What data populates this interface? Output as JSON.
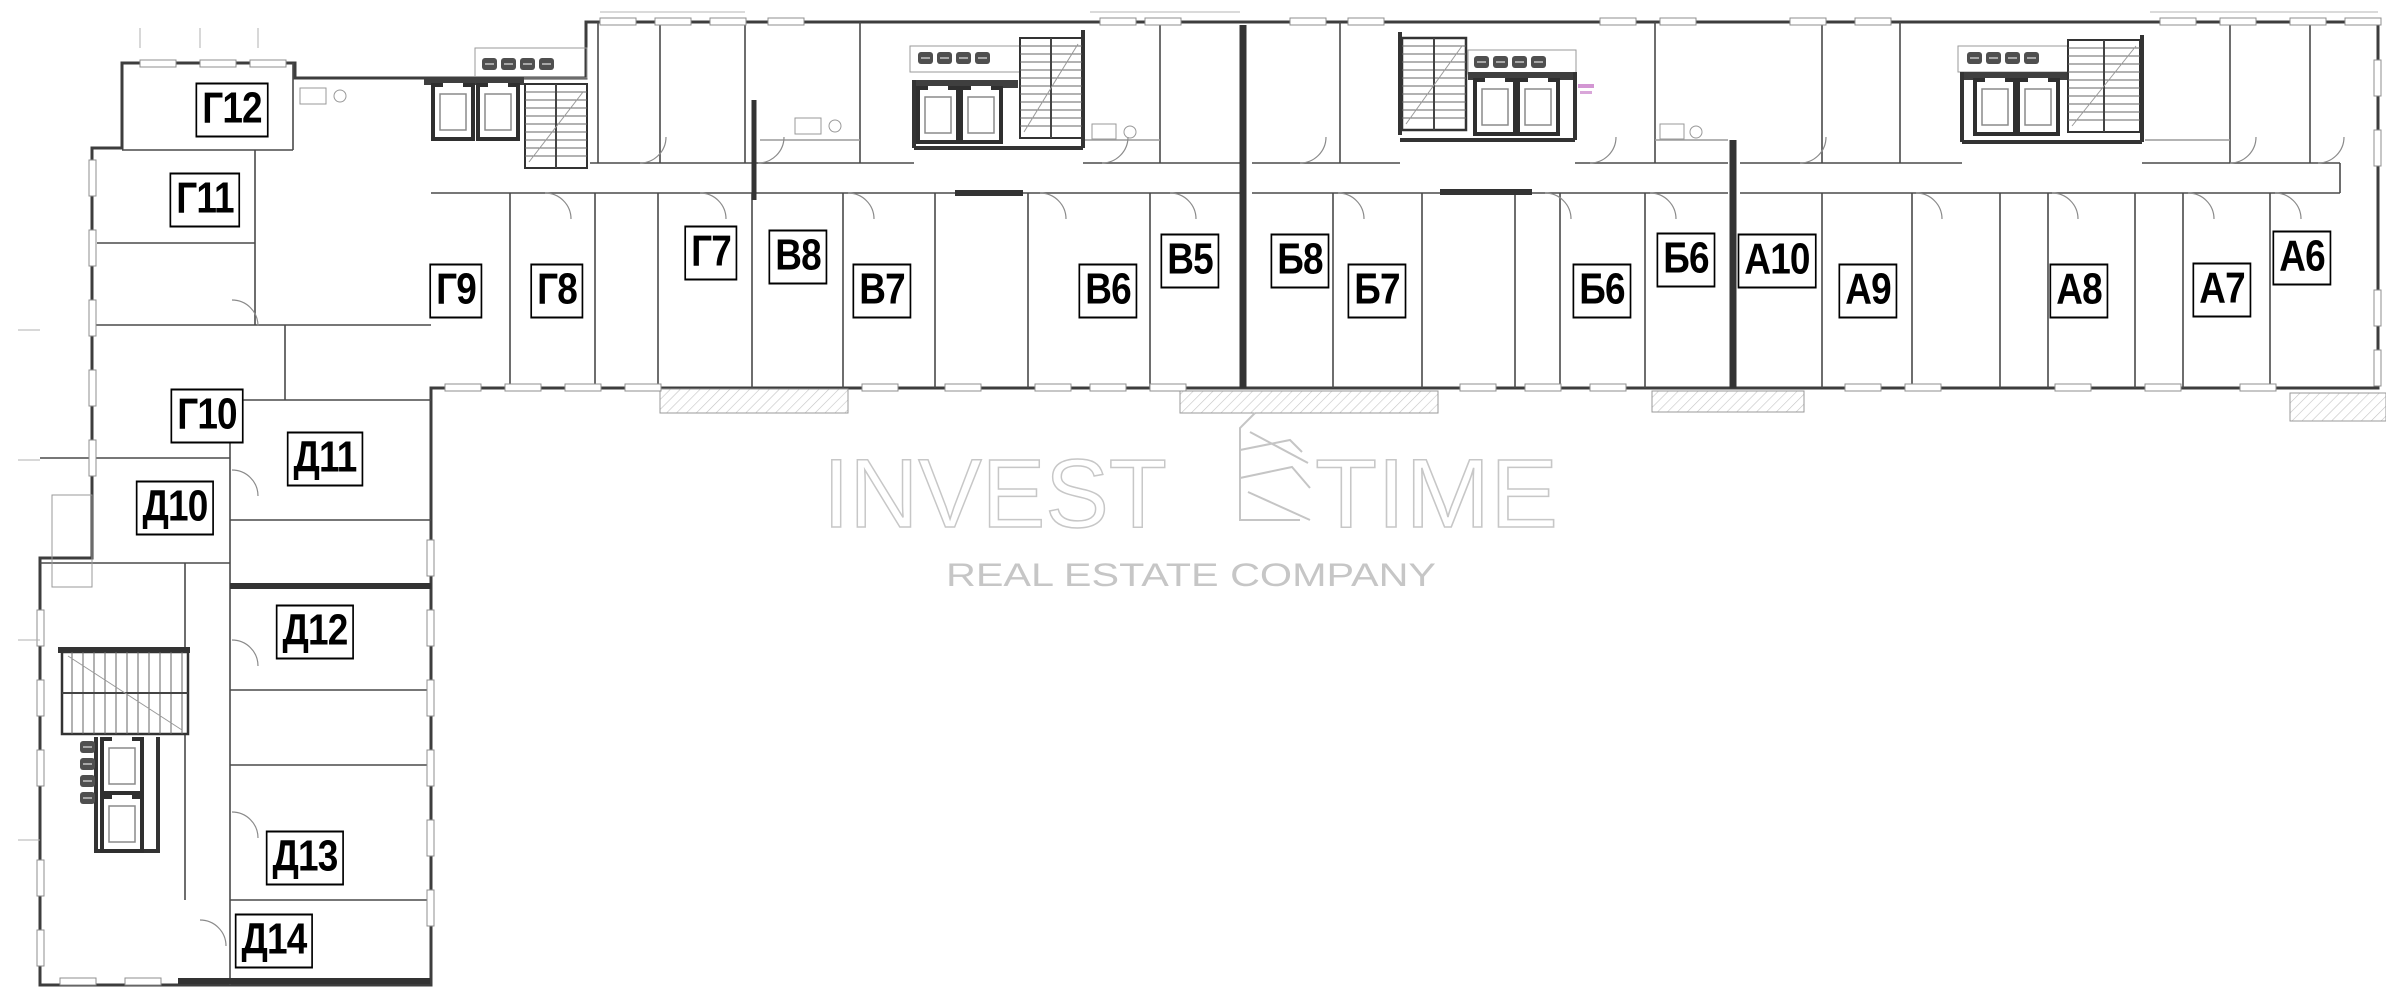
{
  "watermark": {
    "line1_left": "INVEST",
    "line1_right": "TIME",
    "line2": "REAL ESTATE COMPANY",
    "outline_color": "#c7c7c7",
    "fill_color": "#c6c6c6"
  },
  "colors": {
    "wall": "#3d3d3d",
    "heavy_wall": "#333333",
    "label_border": "#000000",
    "background": "#ffffff"
  },
  "units": [
    {
      "id": "g12",
      "label": "Г12",
      "x": 232,
      "y": 110
    },
    {
      "id": "g11",
      "label": "Г11",
      "x": 205,
      "y": 200
    },
    {
      "id": "g10",
      "label": "Г10",
      "x": 207,
      "y": 416
    },
    {
      "id": "d10",
      "label": "Д10",
      "x": 175,
      "y": 508
    },
    {
      "id": "d11",
      "label": "Д11",
      "x": 325,
      "y": 459
    },
    {
      "id": "d12",
      "label": "Д12",
      "x": 315,
      "y": 632
    },
    {
      "id": "d13",
      "label": "Д13",
      "x": 305,
      "y": 858
    },
    {
      "id": "d14",
      "label": "Д14",
      "x": 274,
      "y": 941
    },
    {
      "id": "g9",
      "label": "Г9",
      "x": 456,
      "y": 291
    },
    {
      "id": "g8",
      "label": "Г8",
      "x": 557,
      "y": 291
    },
    {
      "id": "g7",
      "label": "Г7",
      "x": 711,
      "y": 253
    },
    {
      "id": "v8",
      "label": "В8",
      "x": 798,
      "y": 257
    },
    {
      "id": "v7",
      "label": "В7",
      "x": 882,
      "y": 291
    },
    {
      "id": "v6",
      "label": "В6",
      "x": 1108,
      "y": 291
    },
    {
      "id": "v5",
      "label": "В5",
      "x": 1190,
      "y": 261
    },
    {
      "id": "b8",
      "label": "Б8",
      "x": 1300,
      "y": 261
    },
    {
      "id": "b7",
      "label": "Б7",
      "x": 1377,
      "y": 291
    },
    {
      "id": "b6-left",
      "label": "Б6",
      "x": 1602,
      "y": 291
    },
    {
      "id": "b6-right",
      "label": "Б6",
      "x": 1686,
      "y": 260
    },
    {
      "id": "a10",
      "label": "А10",
      "x": 1777,
      "y": 261
    },
    {
      "id": "a9",
      "label": "А9",
      "x": 1868,
      "y": 291
    },
    {
      "id": "a8",
      "label": "А8",
      "x": 2079,
      "y": 291
    },
    {
      "id": "a7",
      "label": "А7",
      "x": 2222,
      "y": 290
    },
    {
      "id": "a6",
      "label": "А6",
      "x": 2302,
      "y": 258
    }
  ]
}
